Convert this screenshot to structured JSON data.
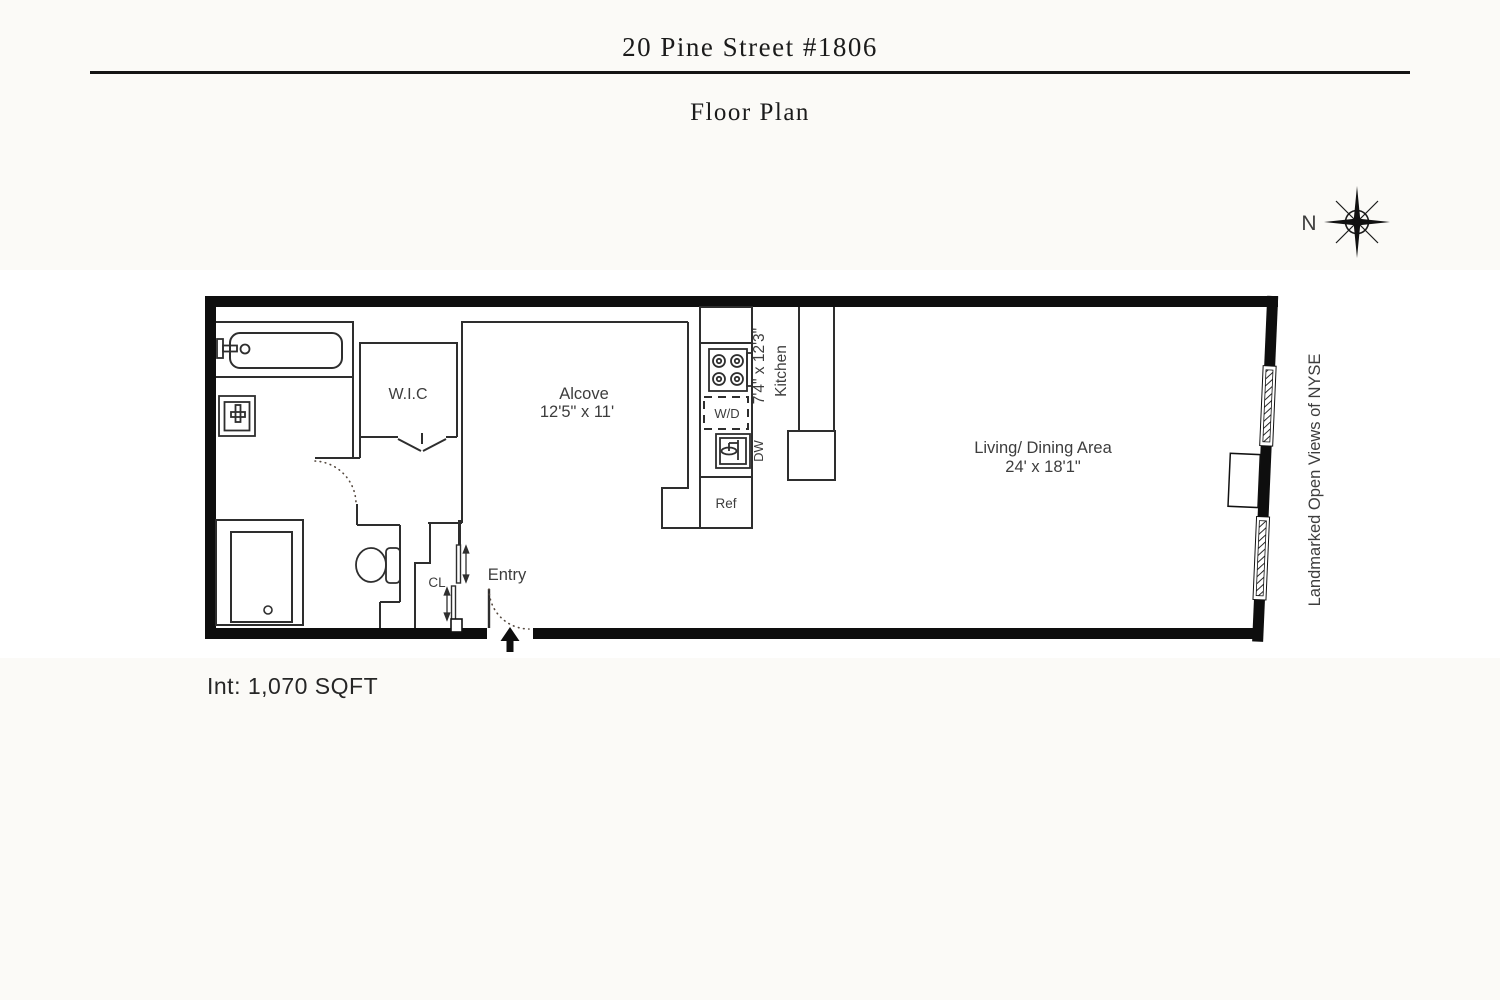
{
  "header": {
    "title": "20 Pine Street #1806",
    "subtitle": "Floor Plan"
  },
  "compass": {
    "north": "N"
  },
  "rooms": {
    "wic": {
      "label": "W.I.C"
    },
    "alcove": {
      "label": "Alcove",
      "dims": "12'5\" x 11'"
    },
    "kitchen": {
      "label": "Kitchen",
      "dims": "7'4\" x 12'3\""
    },
    "living": {
      "label": "Living/ Dining Area",
      "dims": "24' x 18'1\""
    },
    "entry": {
      "label": "Entry"
    },
    "closet": {
      "label": "CL"
    }
  },
  "appliances": {
    "washer_dryer": "W/D",
    "dishwasher": "DW",
    "refrigerator": "Ref"
  },
  "annotations": {
    "windows": "Landmarked Open Views of NYSE"
  },
  "footer": {
    "interior_area": "Int: 1,070 SQFT"
  },
  "colors": {
    "wall": "#0e0e0e",
    "line": "#2e2e2e",
    "background_band": "#ffffff",
    "page_background": "#fbfaf7"
  }
}
